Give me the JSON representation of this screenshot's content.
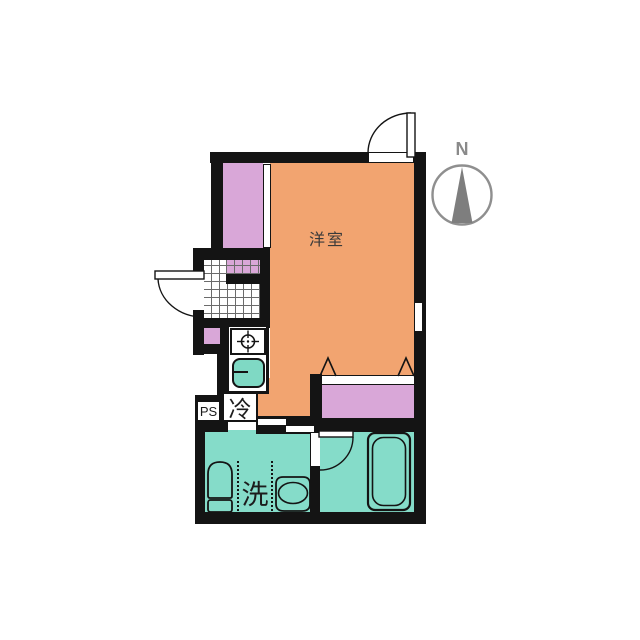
{
  "floorplan": {
    "labels": {
      "room": "洋室",
      "refrigerator": "冷",
      "laundry": "洗",
      "pipe_space": "PS",
      "north": "N"
    },
    "colors": {
      "room_floor": "#F2A470",
      "closet": "#D9A7D8",
      "wet_area_floor": "#85DCC9",
      "sink_fill": "#7FD9C4",
      "wall": "#141414",
      "compass_gray": "#8A8A8A",
      "tile_line": "#6B6B6B"
    },
    "icons": {
      "stove": "burner-registration-mark",
      "sink": "rounded-square-basin",
      "toilet": "toilet-top-view",
      "basin": "oval-washbasin",
      "bathtub": "double-rounded-rect",
      "compass_needle": "north-triangle",
      "doors": "quarter-arc-swing"
    }
  }
}
